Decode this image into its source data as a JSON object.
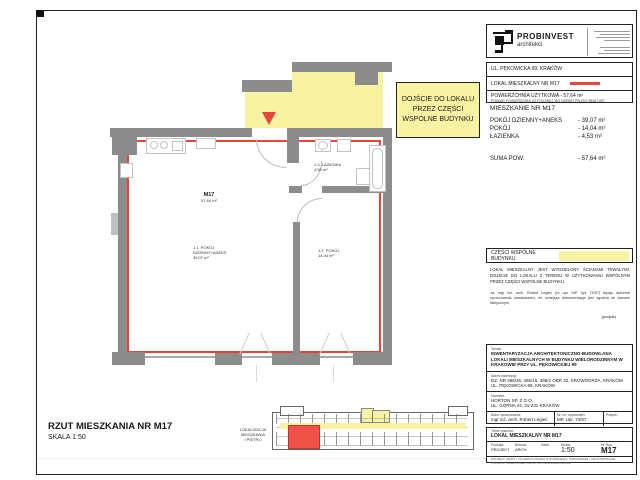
{
  "colors": {
    "yellow": "#F8F3A2",
    "red": "#E8463C",
    "red_line": "#E8433A",
    "wall_gray": "#8C8C8C"
  },
  "logo": {
    "name": "PROBINVEST",
    "subtitle": "architekci"
  },
  "site_box": {
    "address": "UL. PĘKOWICKA 99, KRAKÓW",
    "unit_line": "LOKAL MIESZKALNY NR M17",
    "area_line": "POWIERZCHNIA UŻYTKOWA - 57,64 m²",
    "area_note": "POMIAR POWIERZCHNI UŻYTKOWEJ WG NORMY PN-ISO 9836:1997"
  },
  "summary": {
    "title": "MIESZKANIE NR M17",
    "rows": [
      {
        "label": "POKÓJ DZIENNY+ANEKS",
        "value": "- 39,07 m²"
      },
      {
        "label": "POKÓJ",
        "value": "- 14,04 m²"
      },
      {
        "label": "ŁAZIENKA",
        "value": "- 4,53 m²"
      }
    ],
    "total_label": "SUMA POW:",
    "total_value": "- 57,64 m²"
  },
  "legend": {
    "common_label": "CZĘŚCI WSPÓLNE BUDYNKU"
  },
  "legal": {
    "p1": "LOKAL MIESZKALNY JEST WYDZIELONY ŚCIANAMI TRWAŁYMI. DOJŚCIE DO LOKALU Z TERENU W UŻYTKOWANIU WSPÓLNYM PRZEZ CZĘŚCI WSPÓLNE BUDYNKU.",
    "p2": "Ja, mgr inż. arch. Robert Legieć (nr upr. MP. Upr 73/97) będąc autorem opracowania oświadczam, że niniejsza dokumentacja jest zgodna ze stanem faktycznym.",
    "sign": "(podpis)"
  },
  "plan": {
    "note_lines": [
      "DOJŚCIE DO LOKALU",
      "PRZEZ CZĘŚCI",
      "WSPÓLNE BUDYNKU"
    ],
    "unit_label": "M17",
    "unit_area": "57,64 m²",
    "rooms": [
      {
        "no": "1.1",
        "name": "POKÓJ DZIENNY+ANEKS",
        "area": "39,07 m²"
      },
      {
        "no": "1.2",
        "name": "POKÓJ",
        "area": "14,04 m²"
      },
      {
        "no": "1.3",
        "name": "ŁAZIENKA",
        "area": "4,53 m²"
      }
    ]
  },
  "footer": {
    "drawing_title": "RZUT MIESZKANIA NR M17",
    "scale": "SKALA 1:50",
    "minimap_lines": [
      "LOKALIZACJA",
      "MIESZKANIA",
      "I PIĘTRO"
    ]
  },
  "titleblock": {
    "temat_label": "Temat:",
    "temat": "INWENTARYZACJA ARCHITEKTONICZNO-BUDOWLANA LOKALI MIESZKALNYCH W BUDYNKU WIELORODZINNYM W KRAKOWIE PRZY UL. PĘKOWICKIEJ 99",
    "adres_label": "Adres inwestycji:",
    "adres1": "DZ. NR 396/26, 396/16, 396/2 OBR 32, KROWODRZA, KRAKÓW",
    "adres2": "UL. PĘKOWICKA 99, KRAKÓW",
    "inwestor_label": "Inwestor:",
    "inwestor1": "HORTON SP. Z O.O.",
    "inwestor2": "UL. GÓRNA 44, 31-231 KRAKÓW",
    "autor_label": "Autor opracowania:",
    "autor": "mgr inż. arch. Robert Legieć",
    "upr_label": "Nr i br. uprawnień:",
    "upr": "MP. Upr. 73/97",
    "podpis_label": "Podpis:",
    "tresc_label": "Treść rysunku:",
    "tresc": "LOKAL MIESZKALNY NR M17",
    "funkcja_label": "Funkcja:",
    "funkcja": "PROJEKT.",
    "branza_label": "Branża:",
    "branza": "ARCH.",
    "data_label": "Data:",
    "data": "",
    "skala_label": "Skala:",
    "skala": "1:50",
    "nr_label": "Nr Rys:",
    "nr": "M17",
    "copyright": "PROJEKT OBJĘTY OCHRONĄ PRAWA AUTORSKIEGO. KOPIOWANIE I UDOSTĘPNIANIE OSOBOM TRZECIM BEZ ZGODY AUTORA ZABRONIONE."
  }
}
